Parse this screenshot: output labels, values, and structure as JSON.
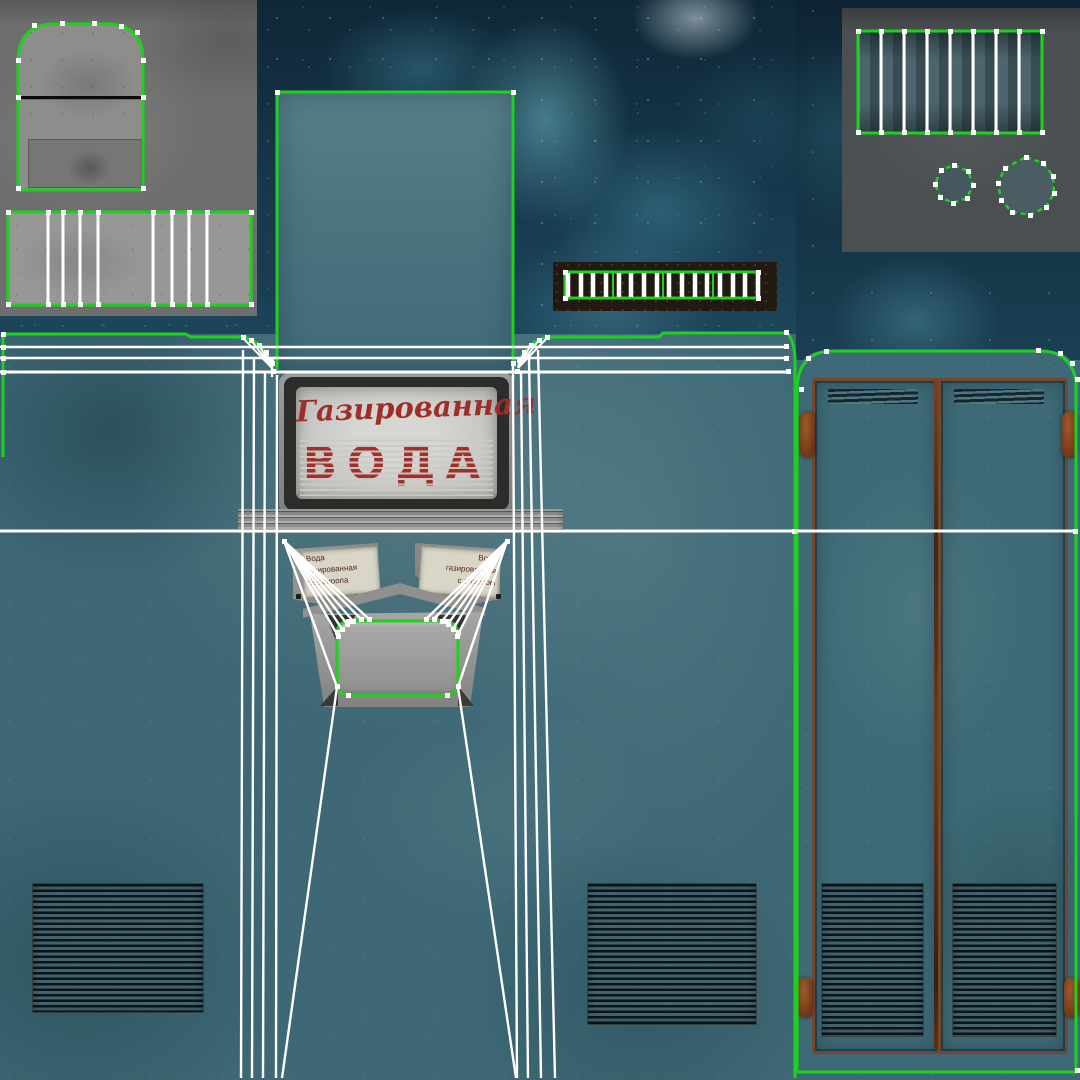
{
  "scene": {
    "description": "Texture atlas with UV wireframe overlay — Soviet soda vending machine",
    "canvas_size": "1080 × 1080"
  },
  "sign": {
    "line1": "Газированная",
    "line2": "ВОДА"
  },
  "plates": {
    "left_lines": [
      "Вода",
      "газированная",
      "без сиропа"
    ],
    "right_lines": [
      "Вода",
      "газированная",
      "с сиропом"
    ]
  },
  "palette": {
    "uv_seam_green": "#1dd21d",
    "uv_edge_white": "#ffffff",
    "body_teal": "#3e6875",
    "grunge_navy": "#143246",
    "bake_panel_gray_light": "#6e6e6e",
    "bake_panel_gray_dark": "#4a4f51",
    "rust_brown": "#7b4123",
    "sign_red": "#a33028",
    "sign_panel_gray": "#c9c9c5",
    "coin_strip_black": "#221a11"
  },
  "islands": {
    "top_left_lid": "machine lid bake (rounded top, 2 sections)",
    "top_left_grille": "front grille bake, 8 white UV cuts",
    "top_right_vent": "side vent slats, 7 white UV cuts",
    "knobs": "2 octagonal knob islands (dashed seams)",
    "cabinet_top": "tall cabinet top panel",
    "coin_grille": "coin grille ladder, 16 white bars",
    "sign": "Газированная ВОДА light-box",
    "dispenser": "cup niche with UV fans",
    "doors": "double rusty back doors with hinges and vents",
    "floor_grilles": "4 rusty horizontal-slat grilles"
  }
}
